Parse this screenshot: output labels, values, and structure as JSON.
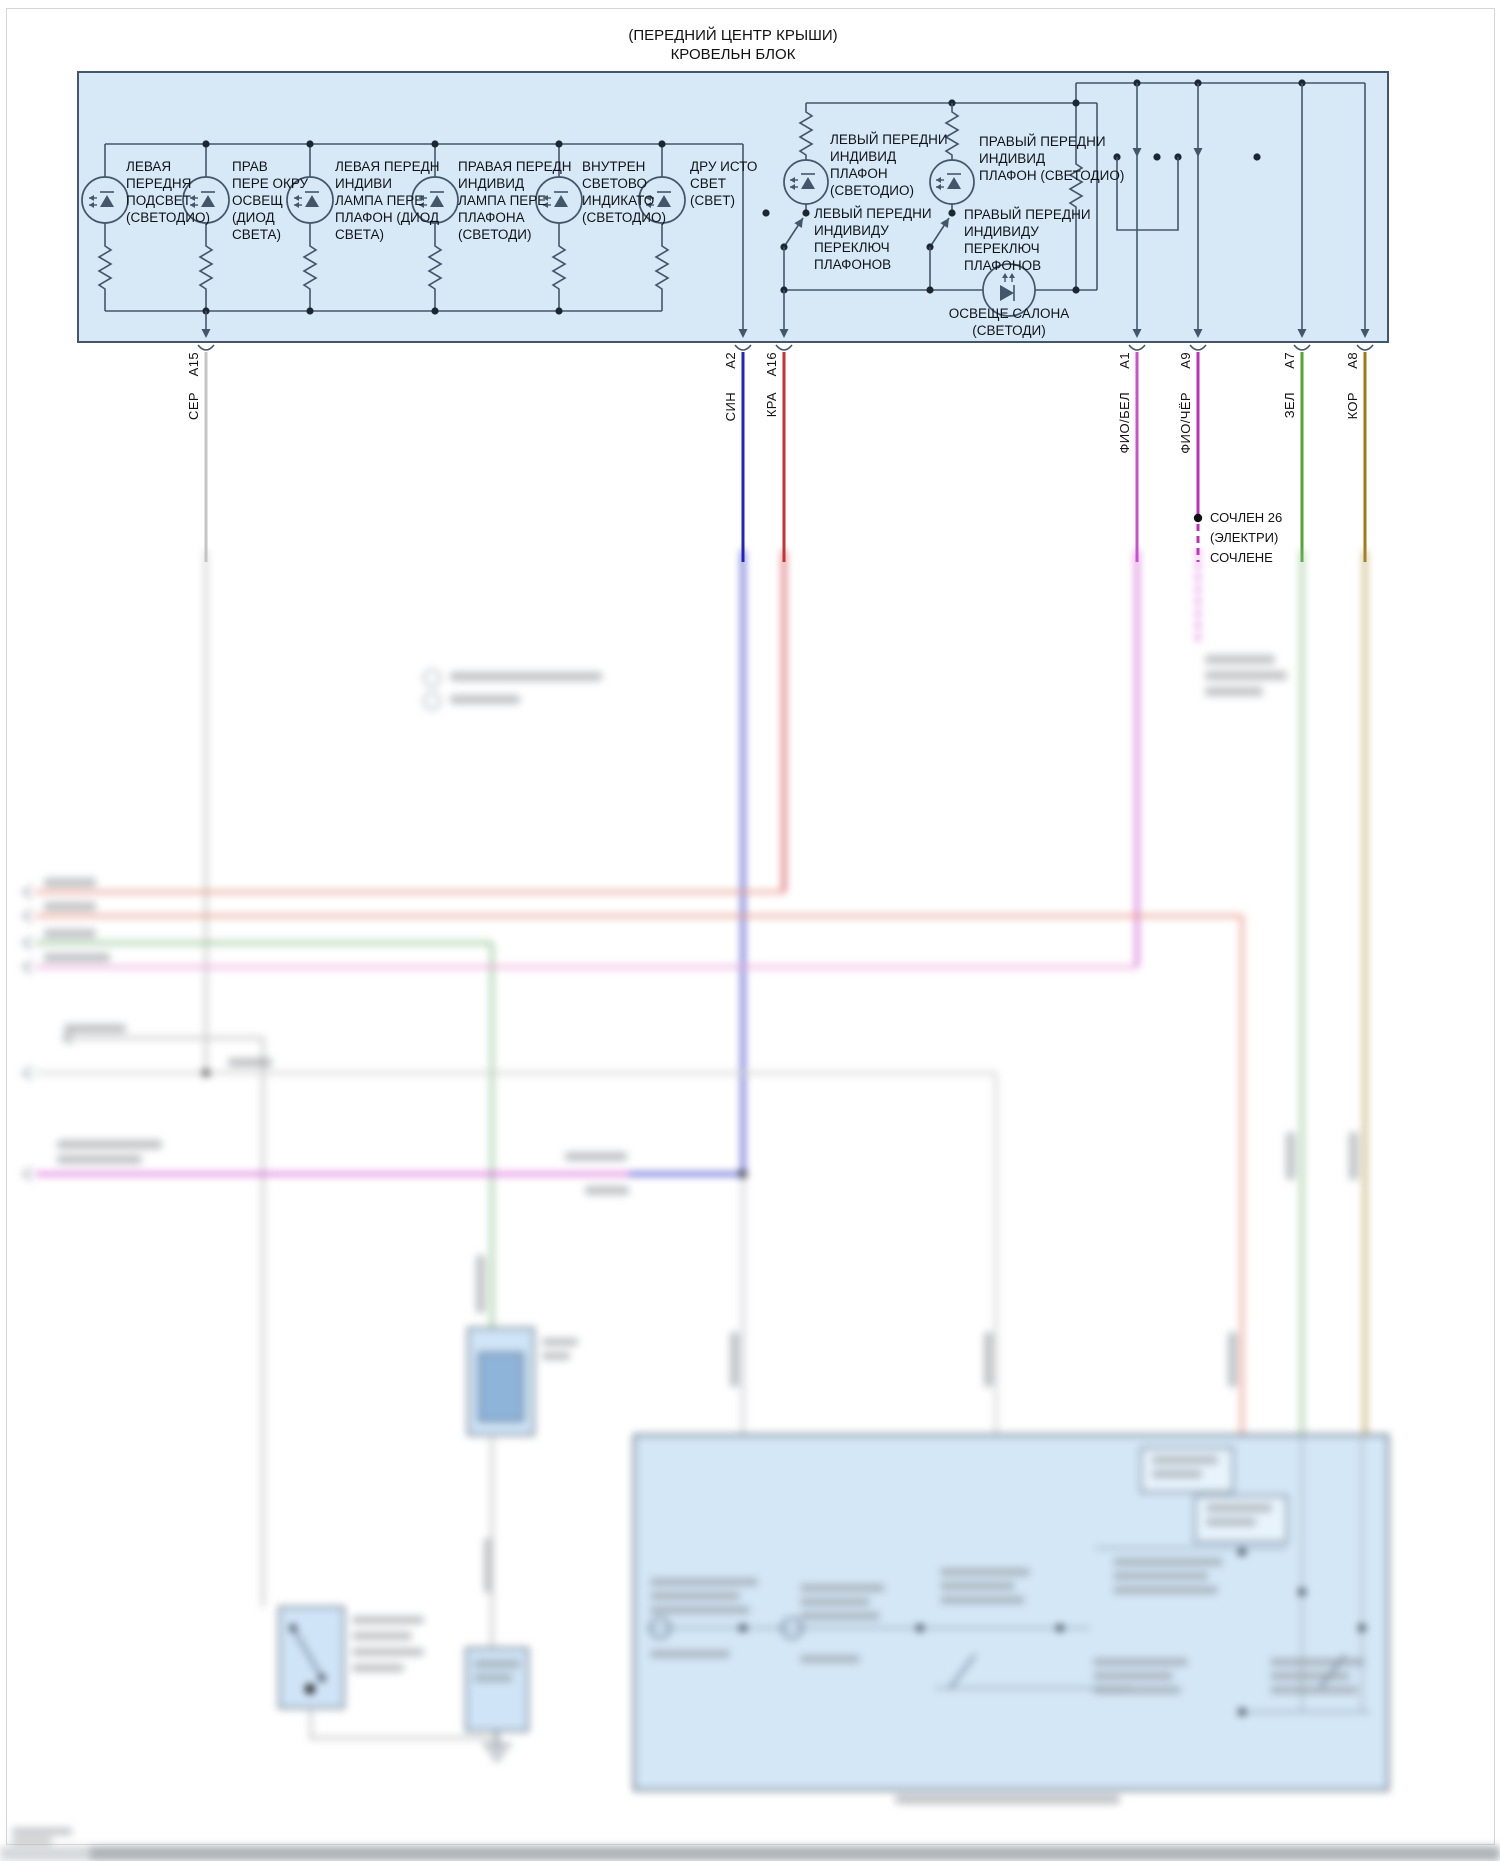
{
  "title": {
    "line1": "(ПЕРЕДНИЙ ЦЕНТР КРЫШИ)",
    "line2": "КРОВЕЛЬН БЛОК"
  },
  "components": {
    "left_front_backlight": "ЛЕВАЯ\nПЕРЕДНЯ\nПОДСВЕТ\n(СВЕТОДИО)",
    "right_front_ambient": "ПРАВ\nПЕРЕ ОКРУ\nОСВЕЩ\n(ДИОД\nСВЕТА)",
    "left_front_map_lamp": "ЛЕВАЯ ПЕРЕДН\nИНДИВИ\nЛАМПА ПЕРЕ\nПЛАФОН (ДИОД\nСВЕТА)",
    "right_front_map_lamp": "ПРАВАЯ ПЕРЕДН\nИНДИВИД\nЛАМПА ПЕРЕ\nПЛАФОНА\n(СВЕТОДИ)",
    "interior_indicator": "ВНУТРЕН\nСВЕТОВО\nИНДИКАТО\n(СВЕТОДИО)",
    "other_light_source": "ДРУ ИСТО\nСВЕТ\n(СВЕТ)",
    "left_front_dome": "ЛЕВЫЙ ПЕРЕДНИ\nИНДИВИД\nПЛАФОН\n(СВЕТОДИО)",
    "left_front_dome_switch": "ЛЕВЫЙ ПЕРЕДНИ\nИНДИВИДУ\nПЕРЕКЛЮЧ\nПЛАФОНОВ",
    "right_front_dome": "ПРАВЫЙ ПЕРЕДНИ\nИНДИВИД\nПЛАФОН (СВЕТОДИО)",
    "right_front_dome_switch": "ПРАВЫЙ ПЕРЕДНИ\nИНДИВИДУ\nПЕРЕКЛЮЧ\nПЛАФОНОВ",
    "cabin_light": "ОСВЕЩЕ САЛОНА\n(СВЕТОДИ)"
  },
  "pins": [
    {
      "pin": "A15",
      "wire": "СЕР",
      "hex": "#c4c4c4"
    },
    {
      "pin": "A2",
      "wire": "СИН",
      "hex": "#2323c2"
    },
    {
      "pin": "A16",
      "wire": "КРА",
      "hex": "#c93232"
    },
    {
      "pin": "A1",
      "wire": "ФИО/БЕЛ",
      "hex": "#cb50cb"
    },
    {
      "pin": "A9",
      "wire": "ФИО/ЧЁР",
      "hex": "#bd2ebd"
    },
    {
      "pin": "A7",
      "wire": "ЗЕЛ",
      "hex": "#56a233"
    },
    {
      "pin": "A8",
      "wire": "КОР",
      "hex": "#9d7c17"
    }
  ],
  "junction_note": "СОЧЛЕН 26\n(ЭЛЕКТРИ)\nСОЧЛЕНЕ",
  "colors": {
    "block_fill": "#d7e8f7",
    "schematic_line": "#44566a",
    "blur_salmon": "#e89686",
    "blur_pink": "#eaa6da",
    "blur_green": "#8cc08c",
    "blur_magenta": "#d44fd4",
    "blur_gray": "#c6c6c6"
  }
}
